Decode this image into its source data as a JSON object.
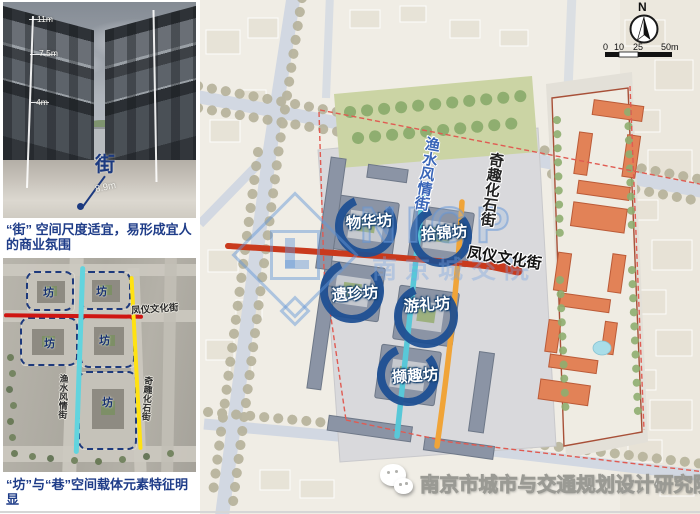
{
  "figures": {
    "street_photo": {
      "dims": {
        "d11": "11m",
        "d75": "7.5m",
        "d4": "4m",
        "d89": "8.9m"
      },
      "street_char": "街",
      "caption": "“街” 空间尺度适宜，易形成宜人的商业氛围"
    },
    "aerial": {
      "fang": "坊",
      "fengyi": "凤仪文化街",
      "yushui": "渔水风情街",
      "qiqu": "奇趣化石街",
      "caption": "“坊”与“巷”空间载体元素特征明显"
    }
  },
  "map": {
    "badges": [
      {
        "label": "物华坊"
      },
      {
        "label": "拾锦坊"
      },
      {
        "label": "遗珍坊"
      },
      {
        "label": "游礼坊"
      },
      {
        "label": "撷趣坊"
      }
    ],
    "streets": {
      "yushui": "渔水风情街",
      "qiqu": "奇趣化石街",
      "fengyi": "凤仪文化街"
    },
    "compass": {
      "north": "N"
    },
    "scalebar": {
      "t0": "0",
      "t10": "10",
      "t25": "25",
      "t50": "50m"
    },
    "watermark": {
      "letters": "NICP",
      "cn": "南京城交院"
    },
    "footer": "南京市城市与交通规划设计研究院",
    "colors": {
      "fengyi_red": "#c93a1d",
      "yushui_cyan": "#58c8d8",
      "qiqu_orange": "#f0a438",
      "badge_navy": "#1d4f93"
    }
  }
}
